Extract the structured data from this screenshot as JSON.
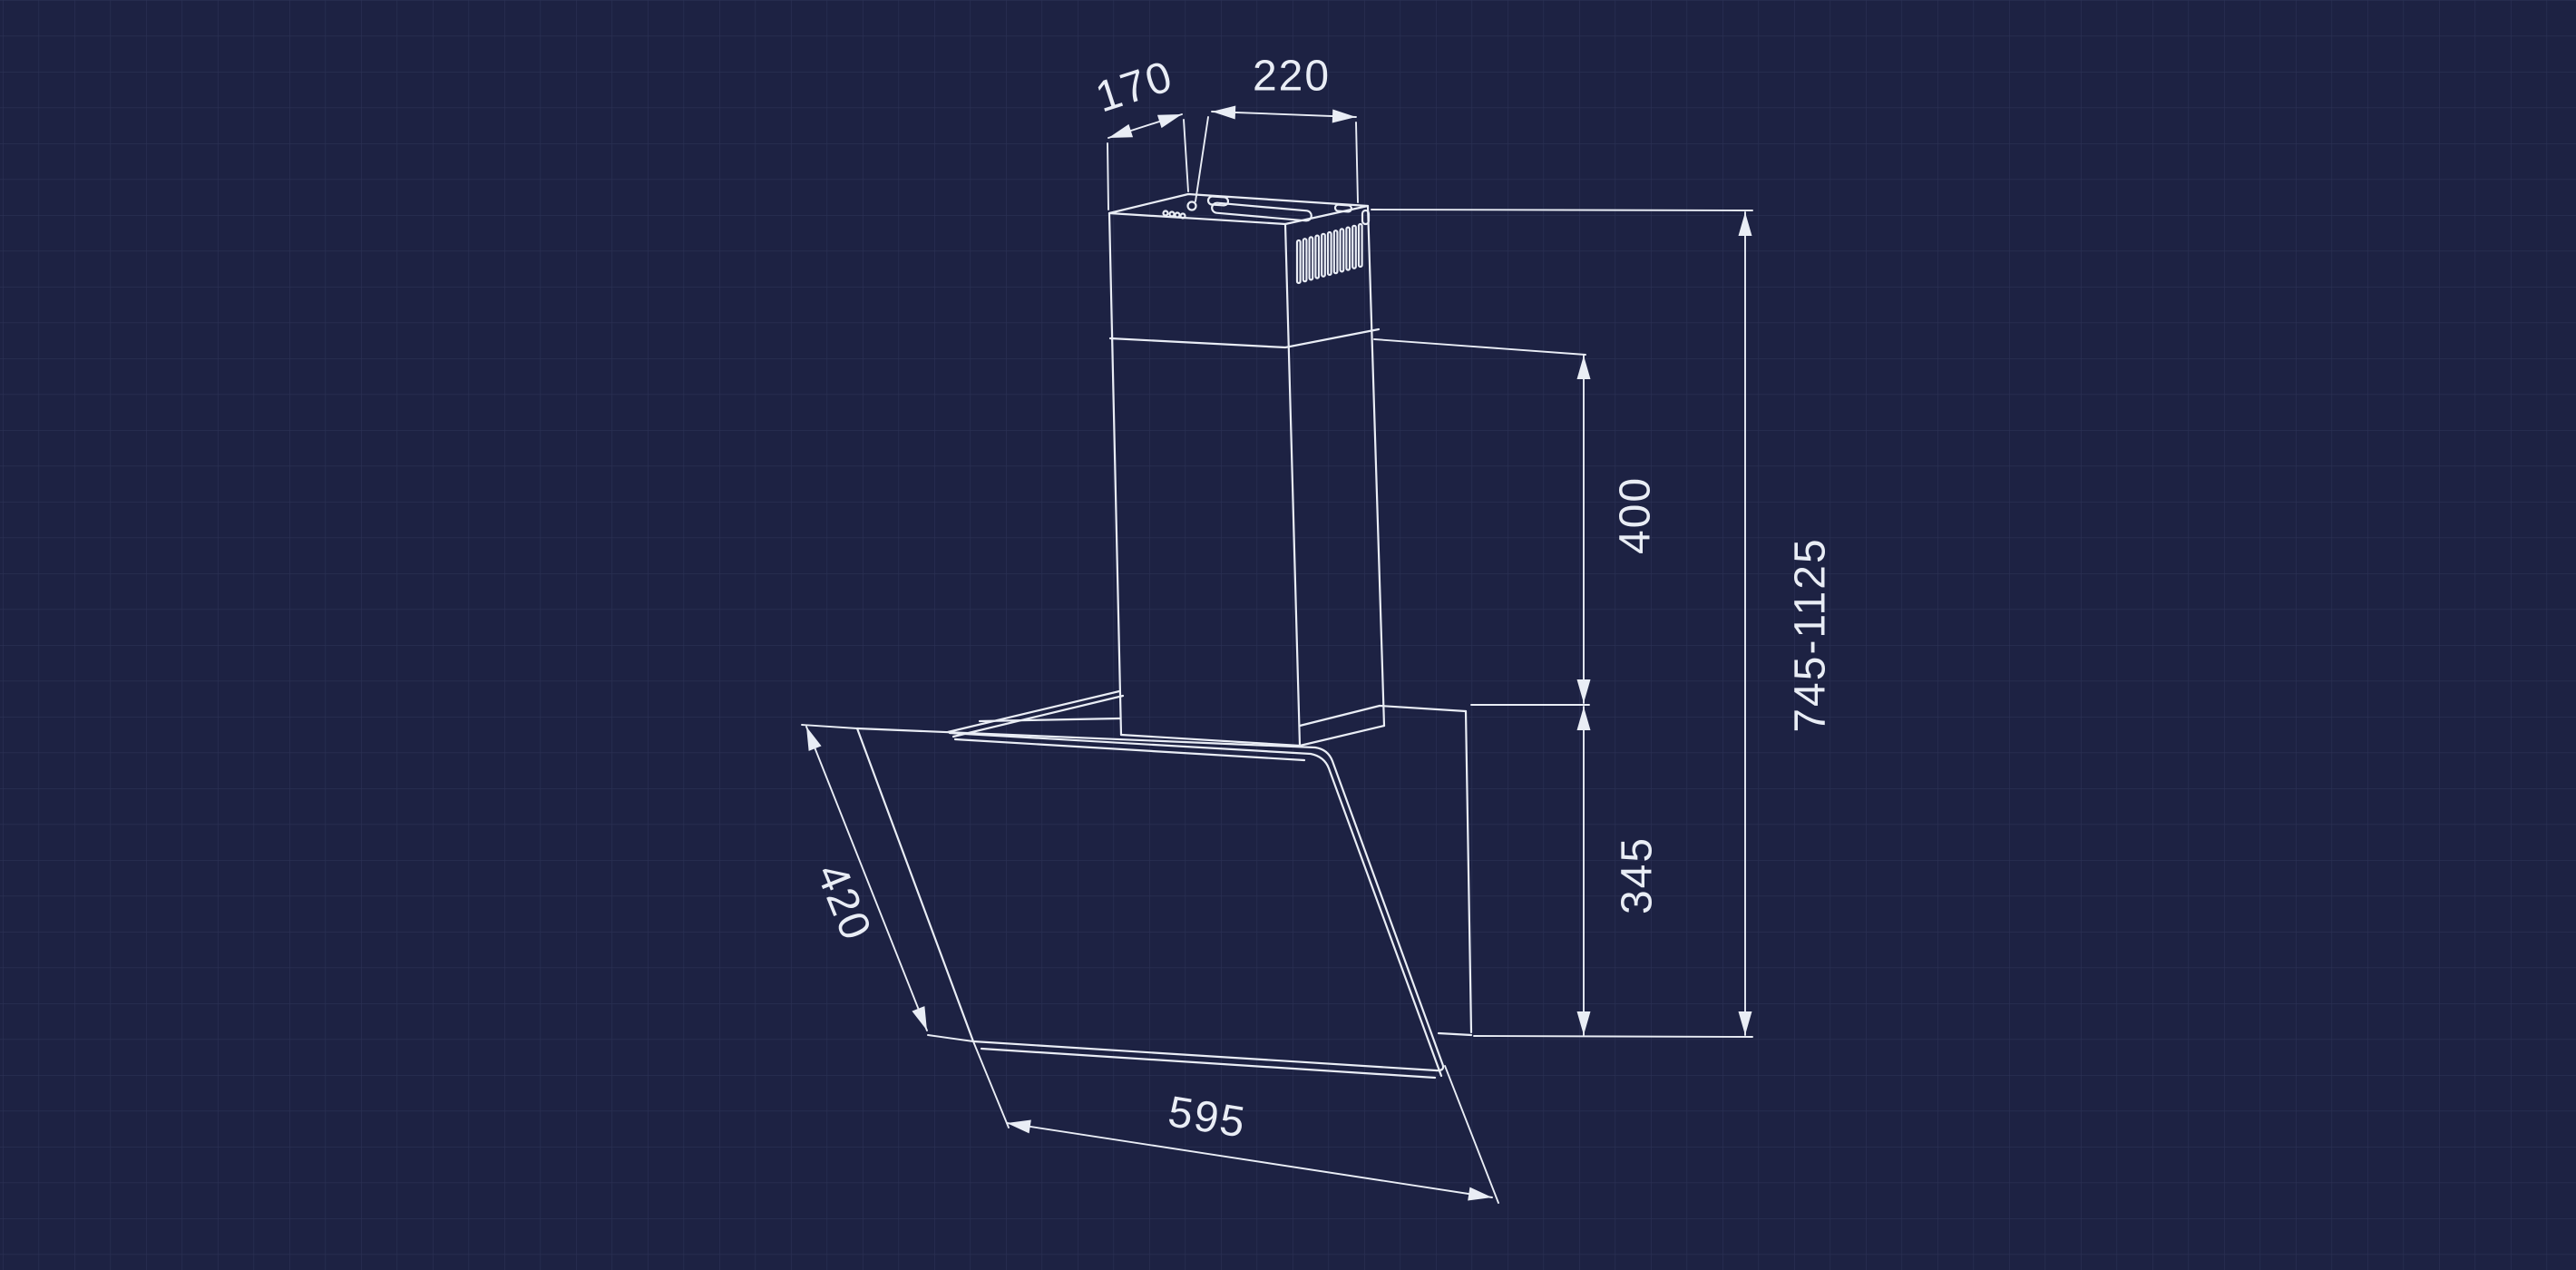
{
  "diagram": {
    "type": "technical-dimension-drawing",
    "subject": "wall-mounted angled cooker hood with telescopic chimney, isometric line drawing on blueprint grid",
    "dimensions": {
      "chimney_top_depth": "170",
      "chimney_top_width": "220",
      "chimney_lower_section_height": "400",
      "hood_body_height": "345",
      "total_height_range": "745-1125",
      "glass_panel_depth": "420",
      "hood_width": "595"
    },
    "colors": {
      "background": "#1d2243",
      "grid_line": "#2b3154",
      "drawing_line": "#e9edf5",
      "label_text": "#e9edf5"
    }
  }
}
